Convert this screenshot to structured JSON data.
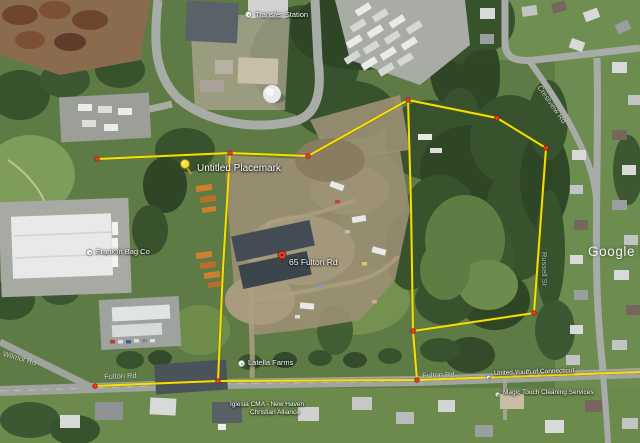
{
  "watermark": {
    "text": "Google Ea"
  },
  "overlay": {
    "line_color": "#ffe600",
    "line_shadow_color": "#6b5d00",
    "vertex_color": "#ea3a20",
    "vertex_edge_color": "#8a1a0a",
    "segments": [
      [
        [
          97,
          159
        ],
        [
          230,
          153
        ]
      ],
      [
        [
          230,
          153
        ],
        [
          308,
          156
        ]
      ],
      [
        [
          308,
          156
        ],
        [
          408,
          100
        ]
      ],
      [
        [
          408,
          100
        ],
        [
          497,
          118
        ],
        [
          546,
          148
        ],
        [
          534,
          313
        ],
        [
          413,
          331
        ]
      ],
      [
        [
          408,
          100
        ],
        [
          411,
          205
        ],
        [
          413,
          331
        ],
        [
          417,
          380
        ]
      ],
      [
        [
          230,
          153
        ],
        [
          223,
          268
        ],
        [
          218,
          381
        ]
      ],
      [
        [
          93,
          386
        ],
        [
          218,
          381
        ],
        [
          417,
          380
        ],
        [
          640,
          372
        ]
      ]
    ],
    "vertices": [
      [
        97,
        159
      ],
      [
        230,
        153
      ],
      [
        308,
        156
      ],
      [
        408,
        100
      ],
      [
        497,
        118
      ],
      [
        546,
        148
      ],
      [
        534,
        313
      ],
      [
        413,
        331
      ],
      [
        417,
        380
      ],
      [
        218,
        381
      ],
      [
        95,
        386
      ]
    ]
  },
  "placemarks": {
    "untitled": {
      "label": "Untitled Placemark"
    },
    "address": {
      "label": "65 Fulton Rd"
    }
  },
  "poi": {
    "transfer": "Transfer Station",
    "franklin": "Franklin Bag Co",
    "latella": "Latella Farms",
    "united": "United Youth of Connecticut",
    "iglesia_line1": "Iglesia CMA - New Haven",
    "iglesia_line2": "Christian Alliance",
    "magic": "Magic Touch Cleaning Services"
  },
  "roads": {
    "fulton_left": "Fulton Rd",
    "fulton_right": "Fulton Rd",
    "crestview": "Crestview Rd",
    "wilmot": "Wilmot Rd",
    "russell": "Russell St"
  }
}
